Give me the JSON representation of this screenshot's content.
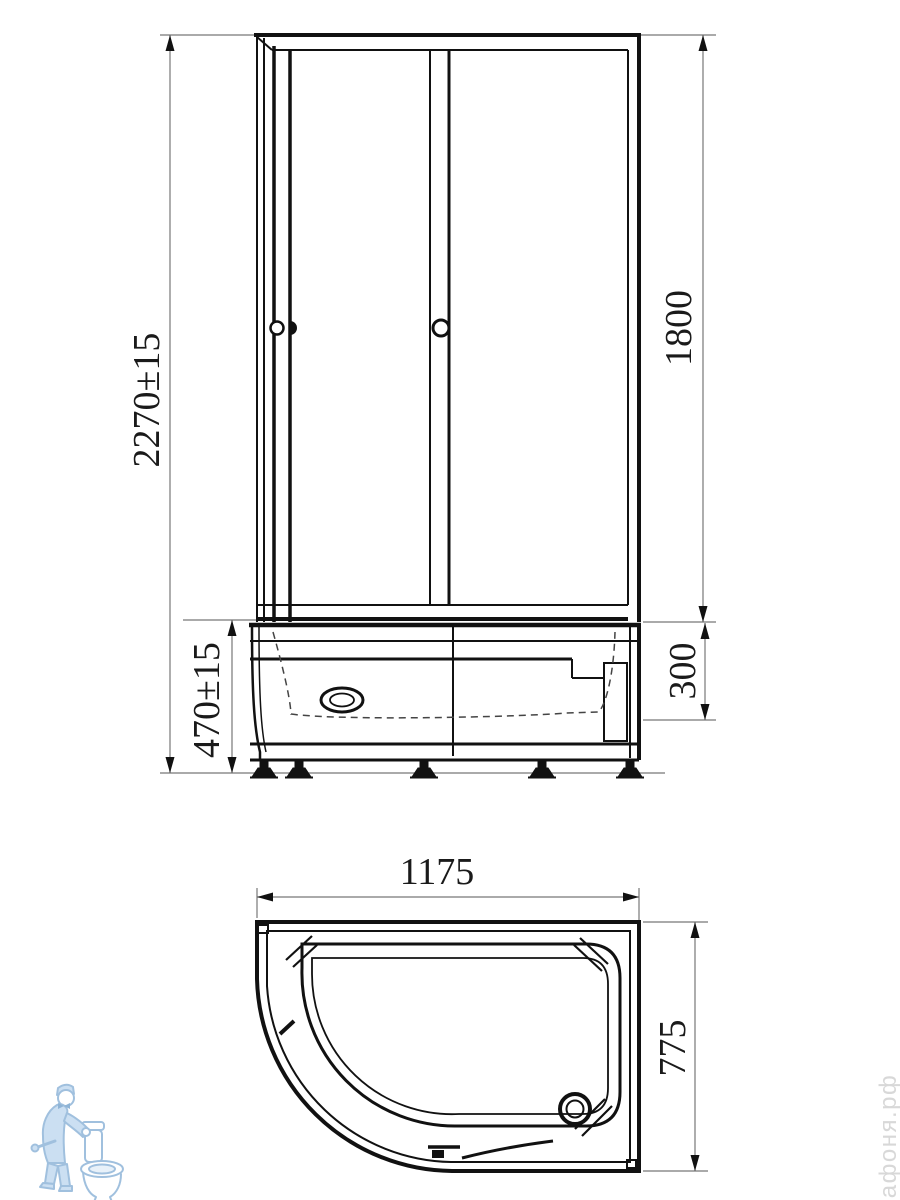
{
  "front_view": {
    "overall_height": "2270±15",
    "cabin_height": "1800",
    "tray_height": "470±15",
    "tray_upper_section": "300"
  },
  "plan_view": {
    "width": "1175",
    "depth": "775"
  },
  "watermark": {
    "site": "афоня.рф",
    "logo": "plumber-with-toilet"
  },
  "colors": {
    "drawing_line": "#111111",
    "dimension_line": "#777777",
    "dimension_text": "#1a1a1a",
    "watermark_logo_stroke": "#a0c0de",
    "watermark_logo_fill": "#cbdff2",
    "watermark_text": "#d8d8d8"
  }
}
